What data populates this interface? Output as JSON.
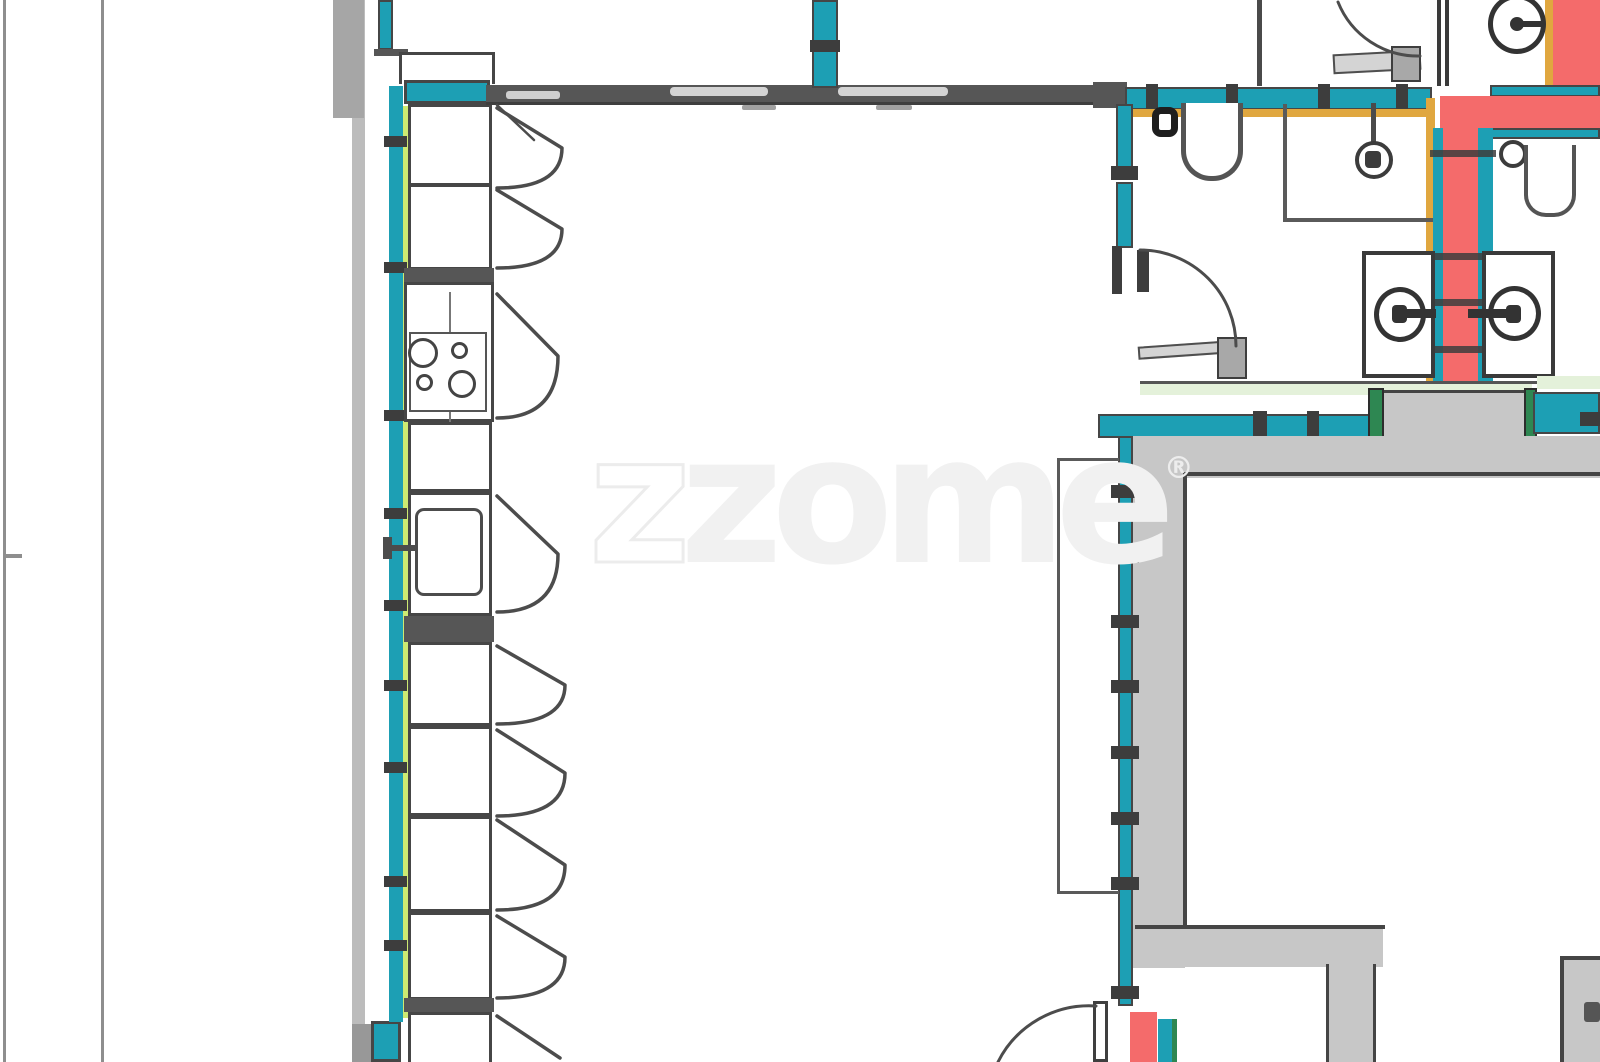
{
  "watermark": {
    "z": "z",
    "rest": "zome",
    "registered": "®"
  },
  "colors": {
    "teal": "#1d9fb4",
    "lime": "#cdea72",
    "yellow": "#e0a73f",
    "red": "#f46b6b",
    "green": "#2e8752",
    "pale_green": "#e4f1da",
    "wall_dark": "#565656",
    "wall_darker": "#3d3d3d",
    "gray_fill": "#c7c7c7",
    "gray_mid": "#a6a6a6",
    "boundary": "#8e8e8e",
    "outline": "#464646",
    "watermark_fill": "#f1f1f1",
    "leaf": "#d4d4d4",
    "hinge": "#a8a8a8"
  },
  "plan": {
    "type": "architectural-floor-plan",
    "rooms": [
      "kitchen-living-area",
      "wc-left",
      "shower-room",
      "wc-right",
      "washroom",
      "bottom-right-room"
    ],
    "fixtures": [
      "stove-4-burners",
      "kitchen-sink",
      "toilet",
      "toilet",
      "pendant-light",
      "wall-basin",
      "wall-basin",
      "extractor-fan"
    ]
  }
}
